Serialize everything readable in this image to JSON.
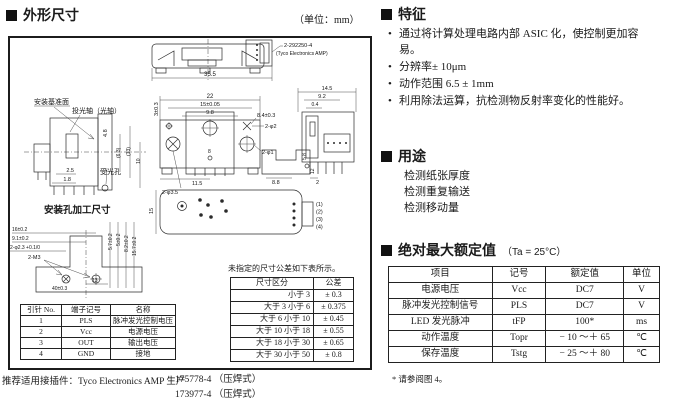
{
  "page": {
    "unit_note": "（单位：mm）"
  },
  "left": {
    "title": "外形尺寸",
    "pin_table": {
      "headers": [
        "引针 No.",
        "端子记号",
        "名称"
      ],
      "rows": [
        [
          "1",
          "PLS",
          "脉冲发光控制电压"
        ],
        [
          "2",
          "Vcc",
          "电源电压"
        ],
        [
          "3",
          "OUT",
          "输出电压"
        ],
        [
          "4",
          "GND",
          "接地"
        ]
      ]
    },
    "tolerance_note": "未指定的尺寸公差如下表所示。",
    "tolerance_table": {
      "headers": [
        "尺寸区分",
        "公差"
      ],
      "rows": [
        [
          "小于 3",
          "± 0.3"
        ],
        [
          "大于 3 小于 6",
          "± 0.375"
        ],
        [
          "大于 6 小于 10",
          "± 0.45"
        ],
        [
          "大于 10 小于 18",
          "± 0.55"
        ],
        [
          "大于 18 小于 30",
          "± 0.65"
        ],
        [
          "大于 30 小于 50",
          "± 0.8"
        ]
      ]
    },
    "connector_note": "推荐适用接插件：Tyco Electronics AMP 生产",
    "connector_parts": [
      "175778-4 （压焊式）",
      "173977-4 （压焊式）"
    ]
  },
  "right": {
    "features": {
      "title": "特征",
      "items": [
        "通过将计算处理电路内部 ASIC 化，使控制更加容易。",
        "分辨率± 10μm",
        "动作范围 6.5 ± 1mm",
        "利用除法运算，抗检测物反射率变化的性能好。"
      ]
    },
    "applications": {
      "title": "用途",
      "items": [
        "检测纸张厚度",
        "检测重复输送",
        "检测移动量"
      ]
    },
    "ratings": {
      "title": "绝对最大额定值",
      "condition": "（Ta = 25°C）",
      "headers": [
        "项目",
        "记号",
        "额定值",
        "单位"
      ],
      "rows": [
        [
          "电源电压",
          "Vcc",
          "DC7",
          "V"
        ],
        [
          "脉冲发光控制信号",
          "PLS",
          "DC7",
          "V"
        ],
        [
          "LED 发光脉冲",
          "tFP",
          "100*",
          "ms"
        ],
        [
          "动作温度",
          "Topr",
          "− 10 ～＋ 65",
          "℃"
        ],
        [
          "保存温度",
          "Tstg",
          "− 25 ～＋ 80",
          "℃"
        ]
      ],
      "footnote": "* 请参阅图 4。"
    }
  },
  "labels": {
    "mounting_ref": "安装基准面",
    "light_axis": "投光轴（光轴）",
    "receive_hole": "受光孔",
    "mounting_holes": "安装孔加工尺寸",
    "callout1": "2-292250-4",
    "callout2": "(Tyco Electronics AMP)",
    "pins": [
      "(1)",
      "(2)",
      "(3)",
      "(4)"
    ]
  },
  "dims": {
    "top_width": "35.5",
    "front_w22": "22",
    "front_w15": "15±0.05",
    "front_w98": "9.8",
    "front_84": "8.4±0.3",
    "front_2phi2": "2-φ2",
    "front_2phi1": "2-φ1",
    "front_115": "11.5",
    "front_2phi35": "2-φ3.5",
    "front_3": "3±0.3",
    "front_8": "8",
    "prof_88": "8.8",
    "prof_58": "5.8",
    "prof_12": "12",
    "right_145": "14.5",
    "right_92": "9.2",
    "right_04": "0.4",
    "right_2": "2",
    "left_48": "4.8",
    "left_25": "2.5",
    "left_18": "1.8",
    "left_63": "(6.3)",
    "left_13": "(13)",
    "left_10": "10",
    "bottom_15": "15",
    "mh_16": "16±0.2",
    "mh_91": "9.1±0.2",
    "mh_phi23": "2-φ2.3 +0.1/0",
    "mh_2m3": "2-M3",
    "mh_13": "13",
    "mh_40": "40±0.3",
    "mh_57": "5.7±0.2",
    "mh_5": "5±0.2",
    "mh_82": "8.2±0.2",
    "mh_157": "15.7±0.2"
  }
}
